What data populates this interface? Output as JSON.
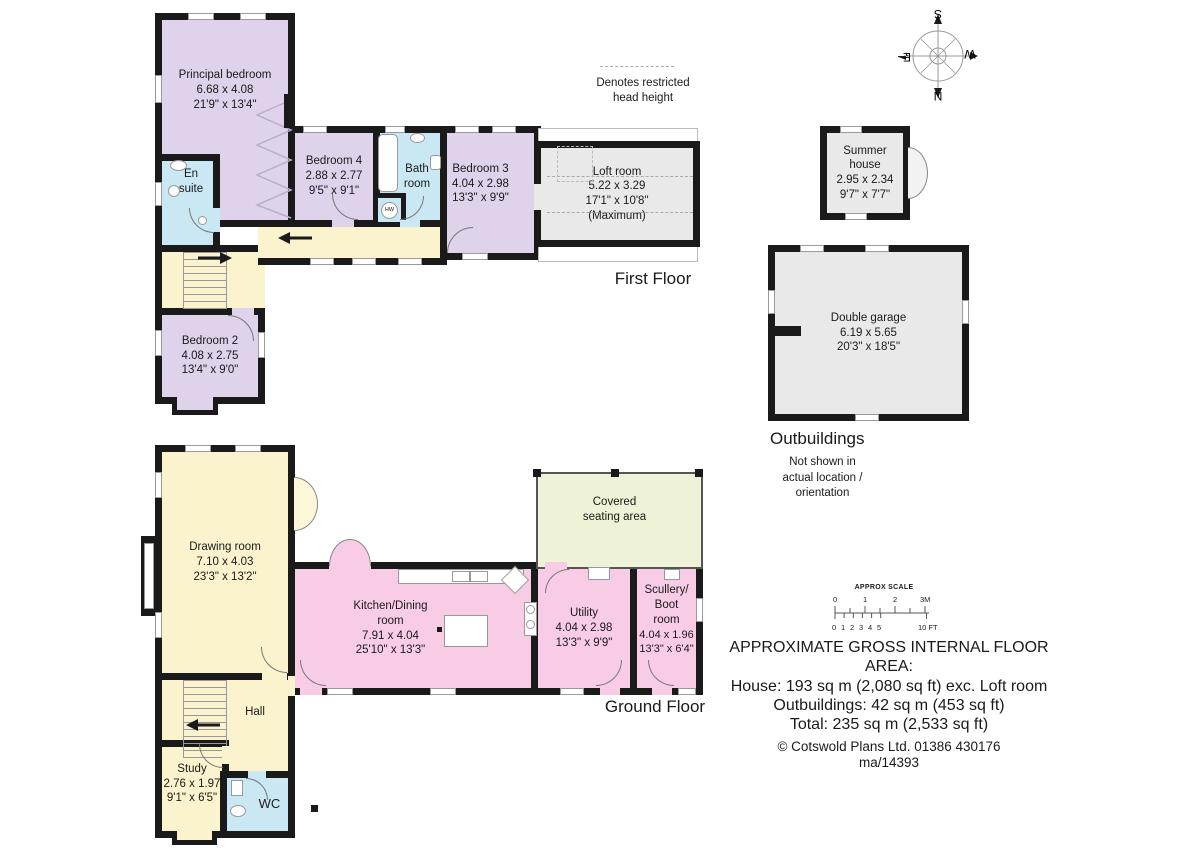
{
  "floors": {
    "first": "First Floor",
    "ground": "Ground Floor"
  },
  "notes": {
    "restricted_l1": "Denotes restricted",
    "restricted_l2": "head height"
  },
  "compass": {
    "n": "N",
    "s": "S",
    "e": "E",
    "w": "W"
  },
  "rooms": {
    "principal": {
      "name": "Principal bedroom",
      "metric": "6.68 x 4.08",
      "imperial": "21'9\" x 13'4\""
    },
    "ensuite": {
      "name": "En suite"
    },
    "bedroom4": {
      "name": "Bedroom 4",
      "metric": "2.88 x 2.77",
      "imperial": "9'5\" x 9'1\""
    },
    "bathroom": {
      "name": "Bath room"
    },
    "bedroom3": {
      "name": "Bedroom 3",
      "metric": "4.04 x 2.98",
      "imperial": "13'3\" x 9'9\""
    },
    "loft": {
      "name": "Loft room",
      "metric": "5.22 x 3.29",
      "imperial": "17'1\" x 10'8\"",
      "note": "(Maximum)"
    },
    "bedroom2": {
      "name": "Bedroom 2",
      "metric": "4.08 x 2.75",
      "imperial": "13'4\" x 9'0\""
    },
    "hw": "HW",
    "drawing": {
      "name": "Drawing room",
      "metric": "7.10 x 4.03",
      "imperial": "23'3\" x 13'2\""
    },
    "kitchen": {
      "l1": "Kitchen/Dining",
      "l2": "room",
      "metric": "7.91 x 4.04",
      "imperial": "25'10\" x 13'3\""
    },
    "utility": {
      "name": "Utility",
      "metric": "4.04 x 2.98",
      "imperial": "13'3\" x 9'9\""
    },
    "scullery": {
      "l1": "Scullery/",
      "l2": "Boot",
      "l3": "room",
      "metric": "4.04 x 1.96",
      "imperial": "13'3\" x 6'4\""
    },
    "covered": {
      "l1": "Covered",
      "l2": "seating area"
    },
    "hall": {
      "name": "Hall"
    },
    "study": {
      "name": "Study",
      "metric": "2.76 x 1.97",
      "imperial": "9'1\" x 6'5\""
    },
    "wc": {
      "name": "WC"
    },
    "summer": {
      "l1": "Summer",
      "l2": "house",
      "metric": "2.95 x 2.34",
      "imperial": "9'7\" x 7'7\""
    },
    "garage": {
      "name": "Double garage",
      "metric": "6.19 x 5.65",
      "imperial": "20'3\" x 18'5\""
    }
  },
  "outbuildings": {
    "title": "Outbuildings",
    "note_l1": "Not shown in",
    "note_l2": "actual location /",
    "note_l3": "orientation"
  },
  "scale": {
    "title": "APPROX SCALE",
    "m": [
      "0",
      "1",
      "2",
      "3M"
    ],
    "ft": [
      "0",
      "1",
      "2",
      "3",
      "4",
      "5"
    ],
    "ft10": "10 FT"
  },
  "summary": {
    "line1": "APPROXIMATE GROSS INTERNAL FLOOR AREA:",
    "line2": "House: 193 sq m (2,080 sq ft) exc. Loft room",
    "line3": "Outbuildings: 42 sq m (453 sq ft)",
    "line4": "Total: 235 sq m (2,533 sq ft)",
    "copyright": "© Cotswold Plans Ltd. 01386 430176",
    "ref": "ma/14393"
  },
  "colors": {
    "wall": "#1a1a1a",
    "bedroom_purple": "#ded3ea",
    "wet_blue": "#c9e8f4",
    "living_yellow": "#fbf3cd",
    "kitchen_pink": "#f8cce4",
    "outbuilding_gray": "#e9e9e9",
    "covered_green": "#eef2d6"
  }
}
